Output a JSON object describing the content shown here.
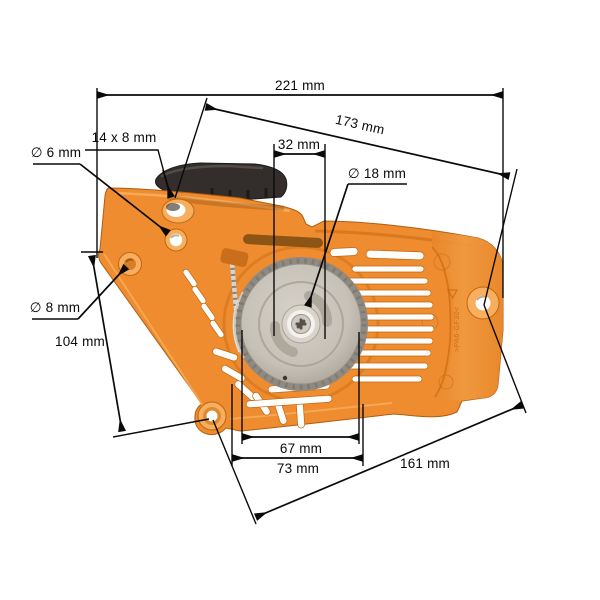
{
  "figure": {
    "description": "Orange chainsaw recoil pull starter with black starter grip, photographed on white, annotated with dimension lines"
  },
  "colors": {
    "housing_orange": "#ee8c2f",
    "housing_orange_light": "#f7ae5e",
    "housing_orange_dark": "#c2660f",
    "housing_orange_deep": "#a85812",
    "handle_black": "#332e2b",
    "handle_highlight": "#5a544f",
    "pulley_gray": "#c9c3b9",
    "pulley_gray_dark": "#8f8a82",
    "pawl_gray": "#aea89d",
    "hub_silver": "#f4f2ee",
    "screw_gray": "#cfcbc3",
    "rope_gray": "#d8d4cb",
    "dimension_line": "#0a0a0a",
    "label_text": "#0a0a0a"
  },
  "labels": {
    "width_total": "221 mm",
    "diagonal_upper": "173 mm",
    "slot_handle": "14 x 8 mm",
    "hole_small": "∅ 6 mm",
    "hole_side": "∅ 8 mm",
    "height_left": "104 mm",
    "hub_offset": "32 mm",
    "hub_diameter": "∅ 18 mm",
    "mount_width_inner": "67 mm",
    "mount_width_outer": "73 mm",
    "diagonal_lower": "161 mm"
  },
  "molded_text": ">PA6-GF30<"
}
